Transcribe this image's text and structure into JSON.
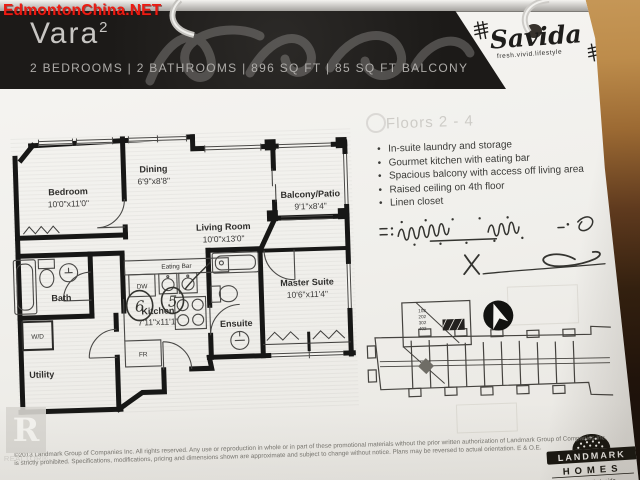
{
  "watermark": {
    "site": "EdmontonChina.NET"
  },
  "header": {
    "title": "Vara",
    "superscript": "2",
    "specs": "2 BEDROOMS | 2 BATHROOMS | 896 SQ FT | 85 SQ FT BALCONY"
  },
  "brand": {
    "name": "Savida",
    "tagline": "fresh.vivid.lifestyle"
  },
  "info": {
    "floors": "Floors 2 - 4",
    "features": [
      "In-suite laundry and storage",
      "Gourmet kitchen with eating bar",
      "Spacious balcony with access off living area",
      "Raised ceiling on 4th floor",
      "Linen closet"
    ],
    "sign_x": "X"
  },
  "floorplan": {
    "rooms": [
      {
        "name": "Bedroom",
        "dims": "10'0\"x11'0\""
      },
      {
        "name": "Dining",
        "dims": "6'9\"x8'8\""
      },
      {
        "name": "Living Room",
        "dims": "10'0\"x13'0\""
      },
      {
        "name": "Balcony/Patio",
        "dims": "9'1\"x8'4\""
      },
      {
        "name": "Master Suite",
        "dims": "10'6\"x11'4\""
      },
      {
        "name": "Kitchen",
        "dims": "7'11\"x11'1\""
      },
      {
        "name": "Bath",
        "dims": ""
      },
      {
        "name": "Ensuite",
        "dims": ""
      },
      {
        "name": "Utility",
        "dims": ""
      }
    ],
    "fixtures": {
      "eating_bar": "Eating Bar",
      "dishwasher": "DW",
      "fridge": "FR",
      "washer_dryer": "W/D"
    },
    "handwritten": [
      "6",
      "5"
    ]
  },
  "siteplan": {
    "units": [
      "102",
      "202",
      "302",
      "402"
    ]
  },
  "footer": {
    "disclaimer1": "©2013 Landmark Group of Companies Inc. All rights reserved. Any use or reproduction in whole or in part of these promotional materials without the prior written authorization of Landmark Group of Companies Inc.",
    "disclaimer2": "is strictly prohibited. Specifications, modifications, pricing and dimensions shown are approximate and subject to change without notice. Plans may be reversed to actual orientation. E & O.E.",
    "realtor": {
      "letter": "R",
      "label": "REALTOR®"
    },
    "landmark": {
      "line1": "LANDMARK",
      "line2": "HOMES",
      "tagline": "It's what's inside"
    }
  },
  "colors": {
    "watermark_red": "#ed1b12",
    "banner": "#1c1a18",
    "wall": "#171716"
  }
}
